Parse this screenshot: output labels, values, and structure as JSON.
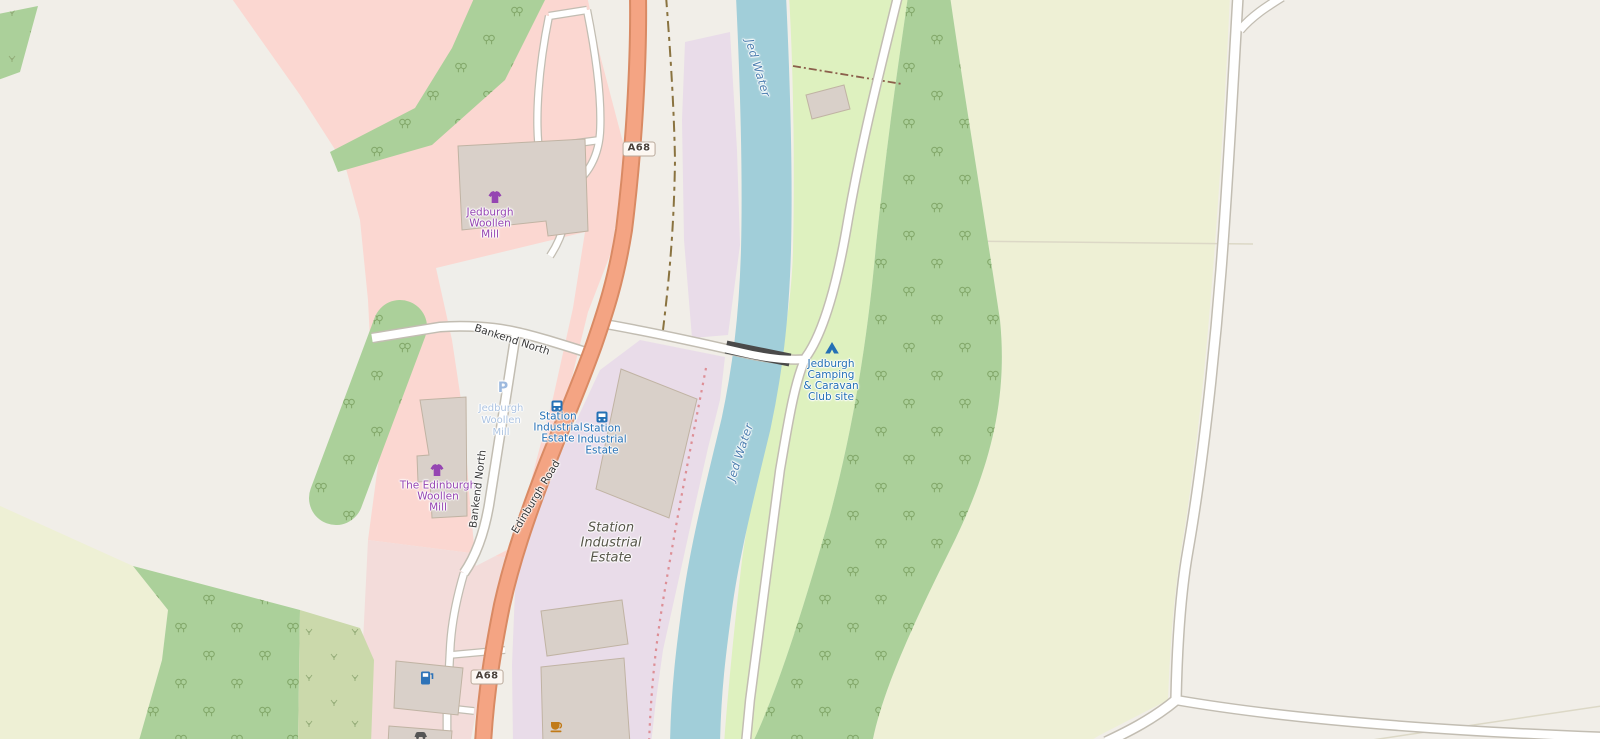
{
  "map": {
    "type": "openstreetmap-style map, Jedburgh area",
    "shield": {
      "a68": "A68"
    },
    "pois": {
      "jedburgh_woollen_mill": {
        "line1": "Jedburgh",
        "line2": "Woollen",
        "line3": "Mill"
      },
      "edinburgh_woollen_mill": {
        "line1": "The Edinburgh",
        "line2": "Woollen",
        "line3": "Mill"
      },
      "parking": {
        "symbol": "P",
        "line1": "Jedburgh",
        "line2": "Woollen",
        "line3": "Mill"
      },
      "bus_stop": {
        "line1": "Station",
        "line2": "Industrial",
        "line3": "Estate"
      },
      "camping": {
        "line1": "Jedburgh",
        "line2": "Camping",
        "line3": "& Caravan",
        "line4": "Club site"
      }
    },
    "areas": {
      "industrial_estate": {
        "line1": "Station",
        "line2": "Industrial",
        "line3": "Estate"
      }
    },
    "streets": {
      "bankend_north": "Bankend North",
      "edinburgh_road": "Edinburgh Road"
    },
    "water": {
      "river": "Jed Water"
    },
    "icons": [
      "clothing-shop-icon",
      "parking-icon",
      "bus-stop-icon",
      "campsite-tent-icon",
      "fuel-station-icon",
      "cafe-icon",
      "car-icon"
    ],
    "colors": {
      "background": "#f1eee8",
      "farmland": "#eef0d5",
      "retail_pink": "#fbd7d1",
      "commercial_pink": "#f3dcda",
      "parking_area": "#efeeea",
      "industrial": "#e9dce9",
      "grass": "#def1bf",
      "forest": "#abd09a",
      "scrub": "#cbd9ab",
      "water": "#a1ced9",
      "trunk_road_fill": "#f4a483",
      "trunk_road_casing": "#d98a64",
      "building": "#d9d0c9",
      "shop_label": "#9545b2",
      "transport_label": "#2470b5",
      "water_label": "#4d7fb0"
    }
  }
}
